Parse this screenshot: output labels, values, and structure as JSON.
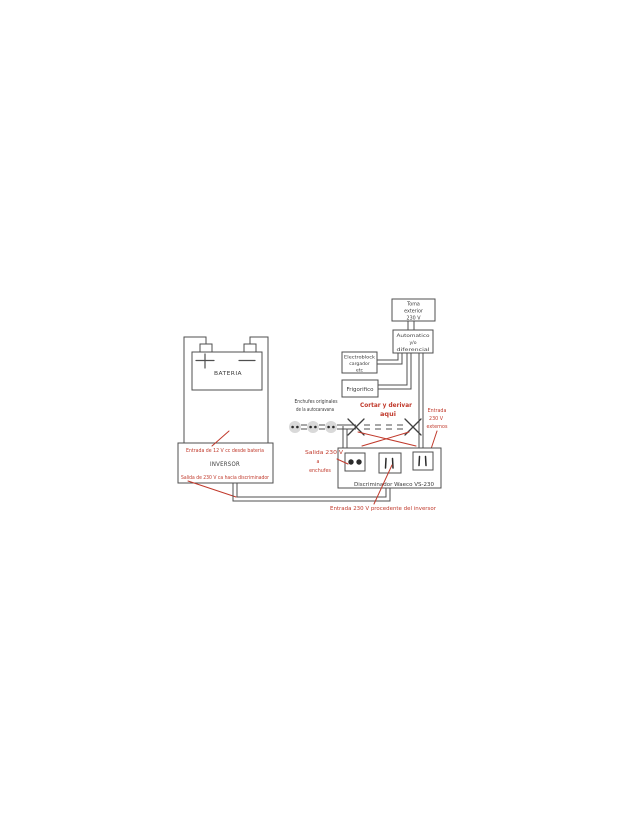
{
  "colors": {
    "background": "#ffffff",
    "wire": "#4f4f4f",
    "ink": "#3a3a3a",
    "red": "#c0392b"
  },
  "battery": {
    "label": "BATERIA"
  },
  "inversor": {
    "label": "INVERSOR",
    "input_note": "Entrada de 12 V cc desde bateria",
    "output_note": "Salida de 230 V ca hacia discriminador"
  },
  "toma_exterior": {
    "line1": "Toma",
    "line2": "exterior",
    "line3": "230 V"
  },
  "automatico": {
    "line1": "Automatico",
    "line2": "y/o",
    "line3": "diferencial"
  },
  "electroblock": {
    "line1": "Electroblock",
    "line2": "cargador",
    "line3": "etc"
  },
  "frigorifico": {
    "label": "Frigorifico"
  },
  "enchufes_originales": {
    "line1": "Enchufes originales",
    "line2": "de la autocaravana"
  },
  "cortar_nota": {
    "line1": "Cortar y derivar",
    "line2": "aqui"
  },
  "entrada_externa": {
    "line1": "Entrada",
    "line2": "230 V",
    "line3": "externos"
  },
  "salida_enchufes": {
    "line1": "Salida 230 V",
    "line2": "a",
    "line3": "enchufes"
  },
  "discriminador": {
    "label": "Discriminador Waeco VS-230"
  },
  "entrada_inversor": {
    "label": "Entrada 230 V procedente del inversor"
  }
}
